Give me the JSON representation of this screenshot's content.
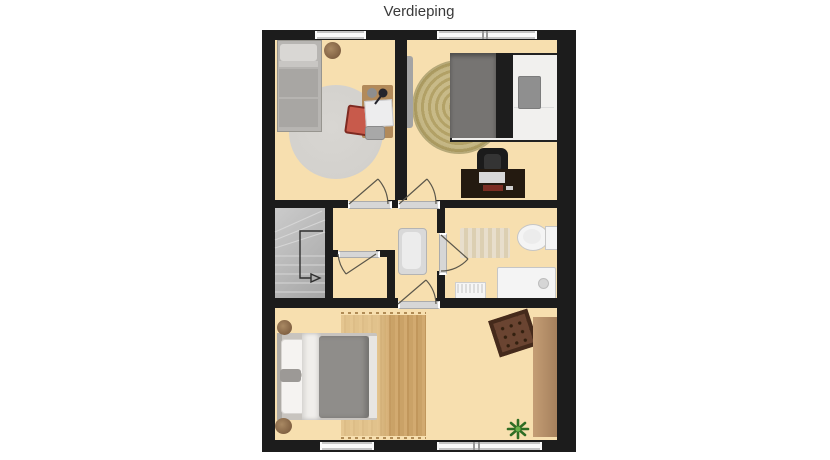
{
  "title": "Verdieping",
  "colors": {
    "wall": "#1c1c1c",
    "floor": "#f7dfaf",
    "stairs-light": "#cbcbcb",
    "stairs-dark": "#a6a6a6",
    "window": "#c6c6c6",
    "threshold": "#d6d6d6",
    "arc": "#5b574b",
    "wood": "#b28a5a",
    "wood-dark": "#7f5f41",
    "desk-dark": "#241a10",
    "red": "#b04136",
    "rug-gray": "#d3d1cd",
    "jute-a": "#b3a267",
    "jute-b": "#c8ba88",
    "rugwood-a": "#d2aa70",
    "rugwood-b": "#c1975c",
    "bench-a": "#c49d75",
    "bench-b": "#a5805c",
    "pouf": "#6a4431",
    "pouf-border": "#452a1b",
    "plant": "#2f6d24",
    "fixture": "#f4f4f4",
    "bed-gray": "#8f8d8a",
    "duvet-dark": "#767472",
    "black-band": "#1d1d1d"
  },
  "floorplan": {
    "floor_label": "Verdieping",
    "rooms": [
      {
        "name": "bedroom-top-left",
        "furniture": [
          "single-bed",
          "round-rug",
          "basket",
          "desk",
          "red-chair",
          "laptop",
          "desk-lamp",
          "stool"
        ]
      },
      {
        "name": "bedroom-top-right",
        "furniture": [
          "double-bed",
          "jute-rug",
          "wall-tv",
          "desk",
          "office-chair",
          "throw-pillow"
        ]
      },
      {
        "name": "landing",
        "furniture": [
          "staircase",
          "stair-direction-arrow",
          "bathtub"
        ]
      },
      {
        "name": "storage-closet",
        "furniture": []
      },
      {
        "name": "bathroom",
        "furniture": [
          "bath-mat",
          "toilet",
          "shower",
          "radiator"
        ]
      },
      {
        "name": "bedroom-bottom",
        "furniture": [
          "double-bed",
          "wood-rug",
          "nightstand",
          "nightstand",
          "pouf",
          "bench",
          "plant"
        ]
      }
    ],
    "doors": 5,
    "windows": 4
  }
}
